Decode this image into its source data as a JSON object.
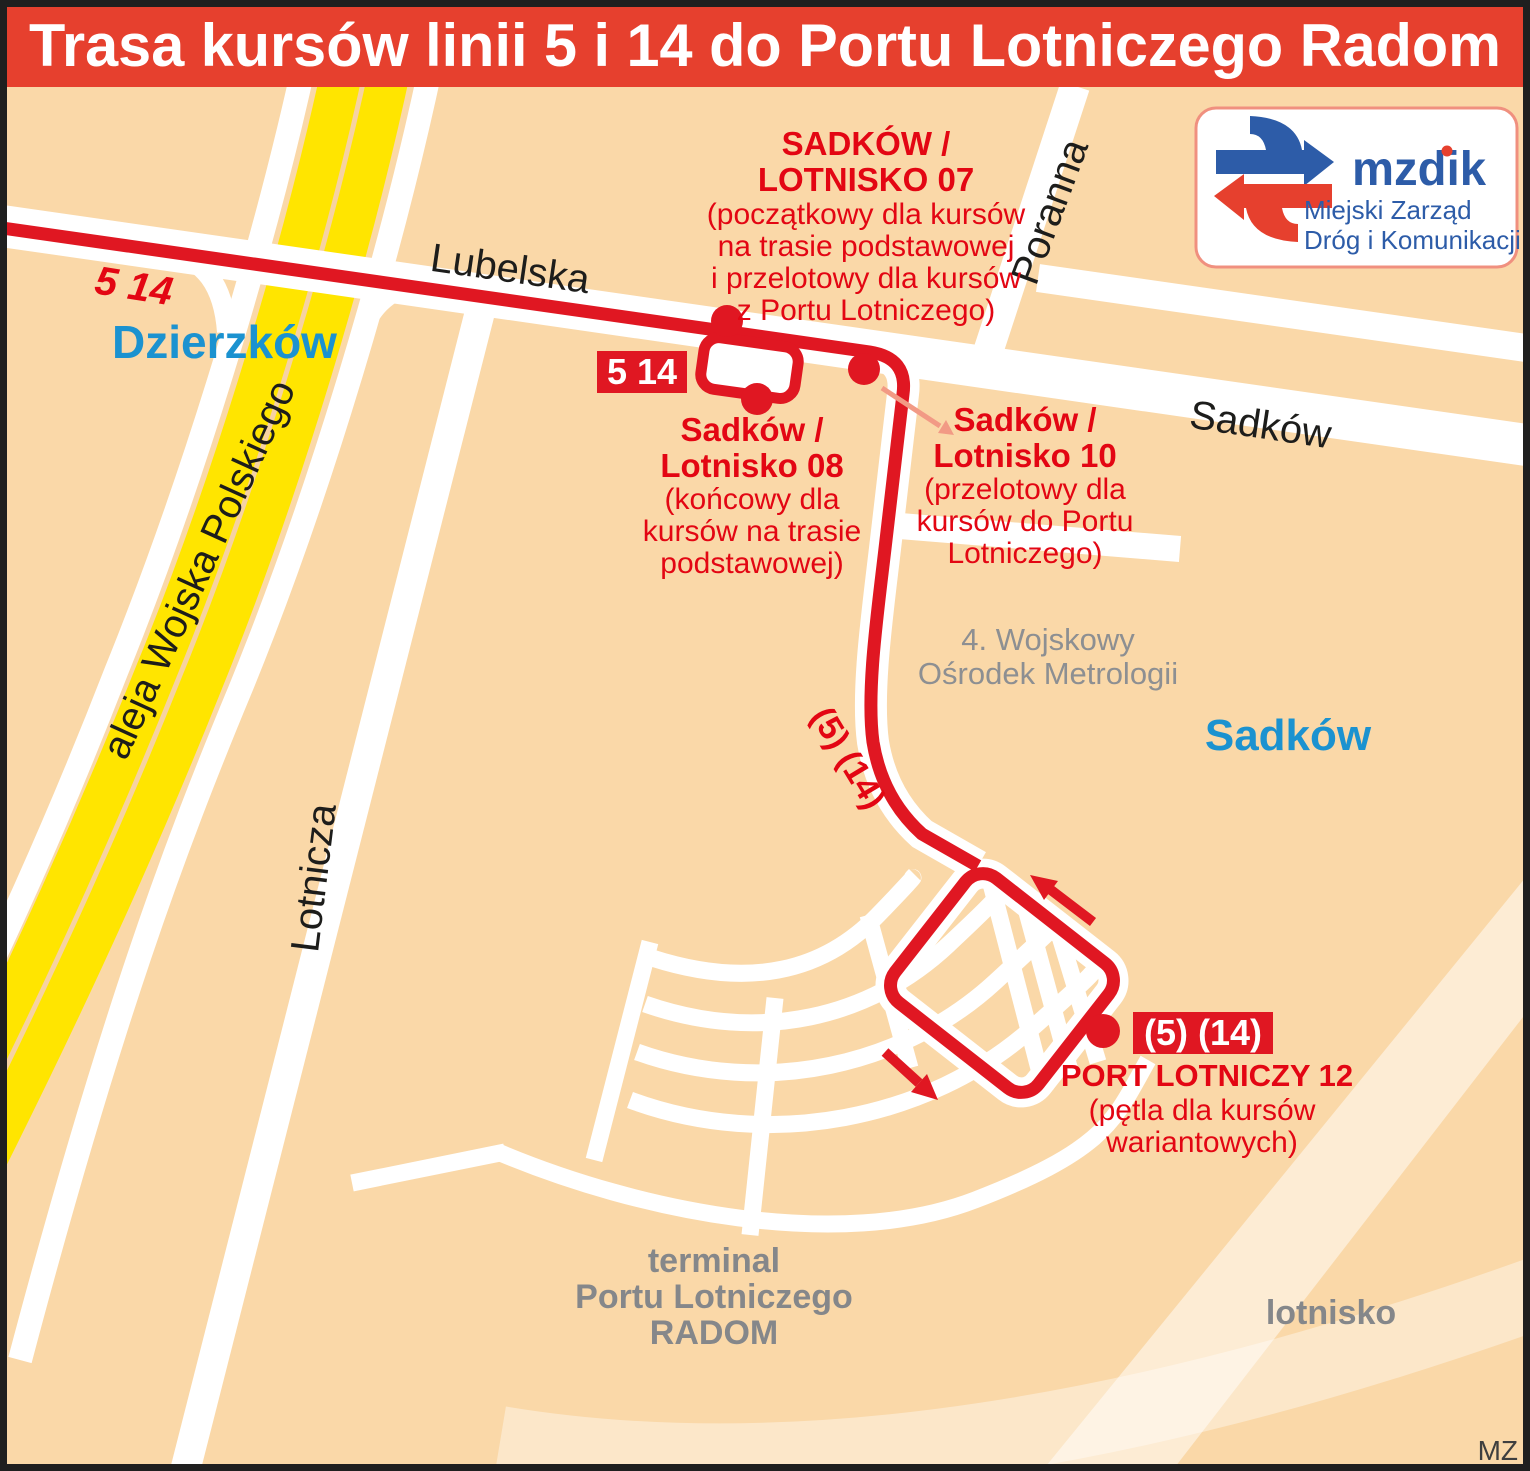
{
  "header": {
    "title": "Trasa kursów linii 5 i 14 do Portu Lotniczego Radom"
  },
  "logo": {
    "name": "mzdik",
    "subtitle_line1": "Miejski Zarząd",
    "subtitle_line2": "Dróg i Komunikacji"
  },
  "route": {
    "lines_label_west": "5 14",
    "badge_label": "5 14",
    "curve_label": "(5) (14)"
  },
  "streets": {
    "lubelska": "Lubelska",
    "wojska_polskiego": "aleja Wojska Polskiego",
    "lotnicza": "Lotnicza",
    "poranna": "Poranna",
    "sadkow": "Sadków"
  },
  "areas": {
    "dzierzkow": "Dzierzków",
    "sadkow": "Sadków",
    "lotnisko": "lotnisko",
    "terminal_lines": [
      "terminal",
      "Portu Lotniczego",
      "RADOM"
    ],
    "facility_lines": [
      "4. Wojskowy",
      "Ośrodek Metrologii"
    ]
  },
  "stops": {
    "s07": {
      "name_lines": [
        "SADKÓW /",
        "LOTNISKO 07"
      ],
      "note_lines": [
        "(początkowy dla kursów",
        "na trasie podstawowej",
        "i przelotowy dla kursów",
        "z Portu Lotniczego)"
      ]
    },
    "s08": {
      "name_lines": [
        "Sadków /",
        "Lotnisko 08"
      ],
      "note_lines": [
        "(końcowy dla",
        "kursów na trasie",
        "podstawowej)"
      ]
    },
    "s10": {
      "name_lines": [
        "Sadków /",
        "Lotnisko 10"
      ],
      "note_lines": [
        "(przelotowy dla",
        "kursów do Portu",
        "Lotniczego)"
      ]
    },
    "s12": {
      "badge": "(5) (14)",
      "name": "PORT LOTNICZY 12",
      "note_lines": [
        "(pętla dla kursów",
        "wariantowych)"
      ]
    }
  },
  "credit": "MZ",
  "colors": {
    "background": "#fad8a8",
    "banner_red": "#e6402e",
    "route_red": "#e01722",
    "text_red": "#e30613",
    "annotation_arrow": "#f29a85",
    "area_blue": "#1b92d0",
    "logo_blue": "#2d5ca8",
    "road_white": "#ffffff",
    "yellow_road": "#ffe500",
    "gray_label": "#85878a",
    "frame": "#1f1f1f"
  }
}
